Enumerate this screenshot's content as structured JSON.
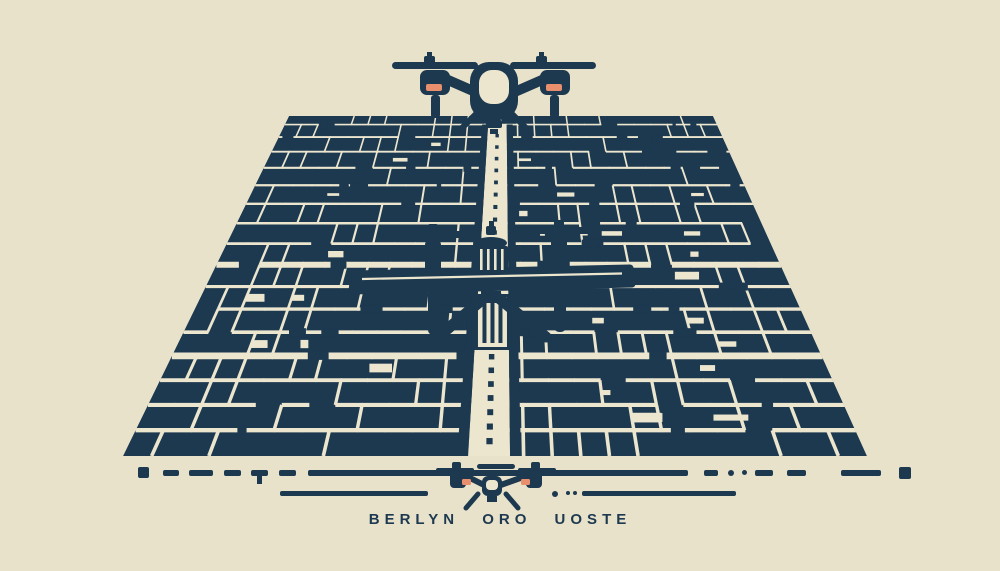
{
  "palette": {
    "background": "#e9e2cb",
    "ink": "#1d3950",
    "street": "#ece6cf",
    "accent": "#ea8f6d"
  },
  "caption": {
    "text": "BERLYN ORO UOSTE"
  }
}
